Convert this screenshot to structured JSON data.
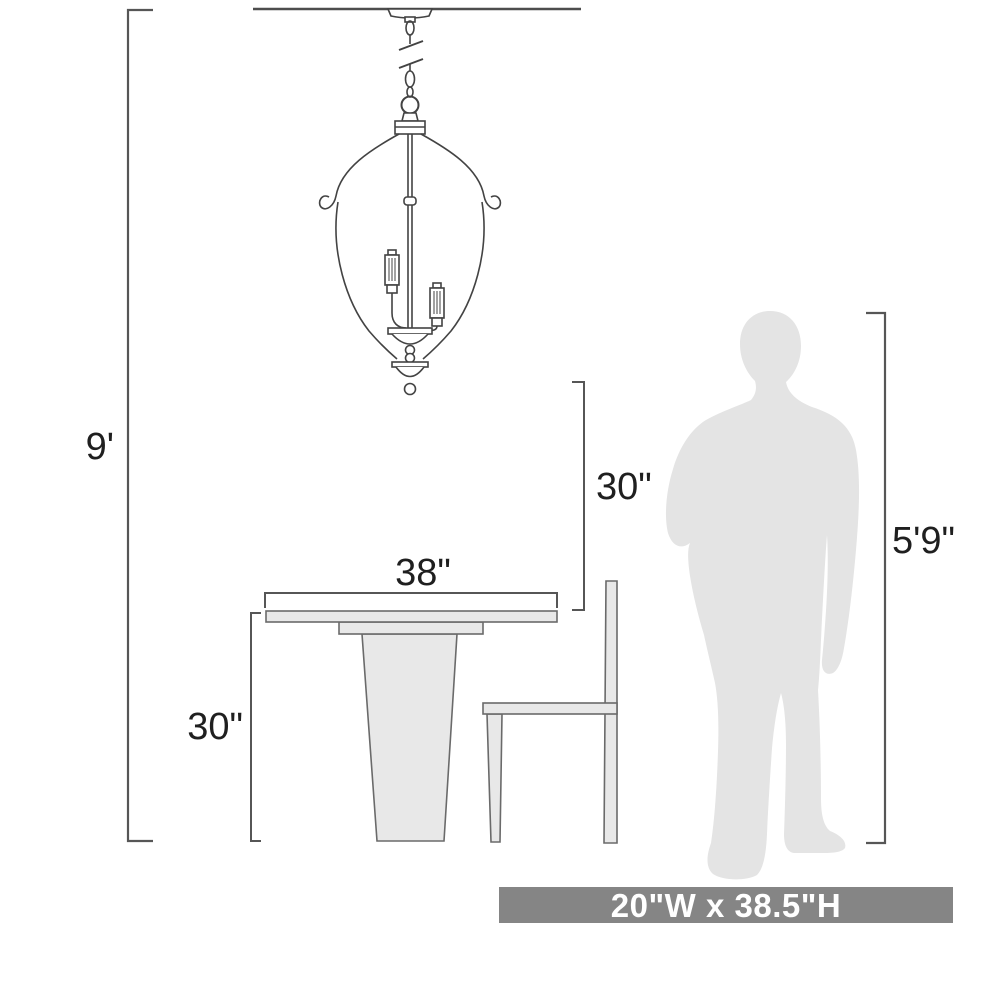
{
  "dimensions": {
    "ceiling_height": "9'",
    "fixture_to_table_clearance": "30\"",
    "table_width": "38\"",
    "table_height": "30\"",
    "person_height": "5'9\"",
    "fixture_size": "20\"W x 38.5\"H"
  },
  "illustrations": [
    {
      "name": "chandelier",
      "kind": "3-light caged pendant hanging from ceiling by chain"
    },
    {
      "name": "pedestal-table",
      "kind": "side view dining table"
    },
    {
      "name": "chair",
      "kind": "side profile dining chair"
    },
    {
      "name": "person-silhouette",
      "kind": "standing man silhouette for scale"
    }
  ],
  "colors": {
    "background": "#ffffff",
    "line_art": "#434343",
    "dimension_lines": "#565656",
    "furniture_fill": "#e8e8e8",
    "silhouette_fill": "#e4e4e4",
    "banner_background": "#858585",
    "banner_text": "#ffffff",
    "label_text": "#1f1f1f"
  }
}
